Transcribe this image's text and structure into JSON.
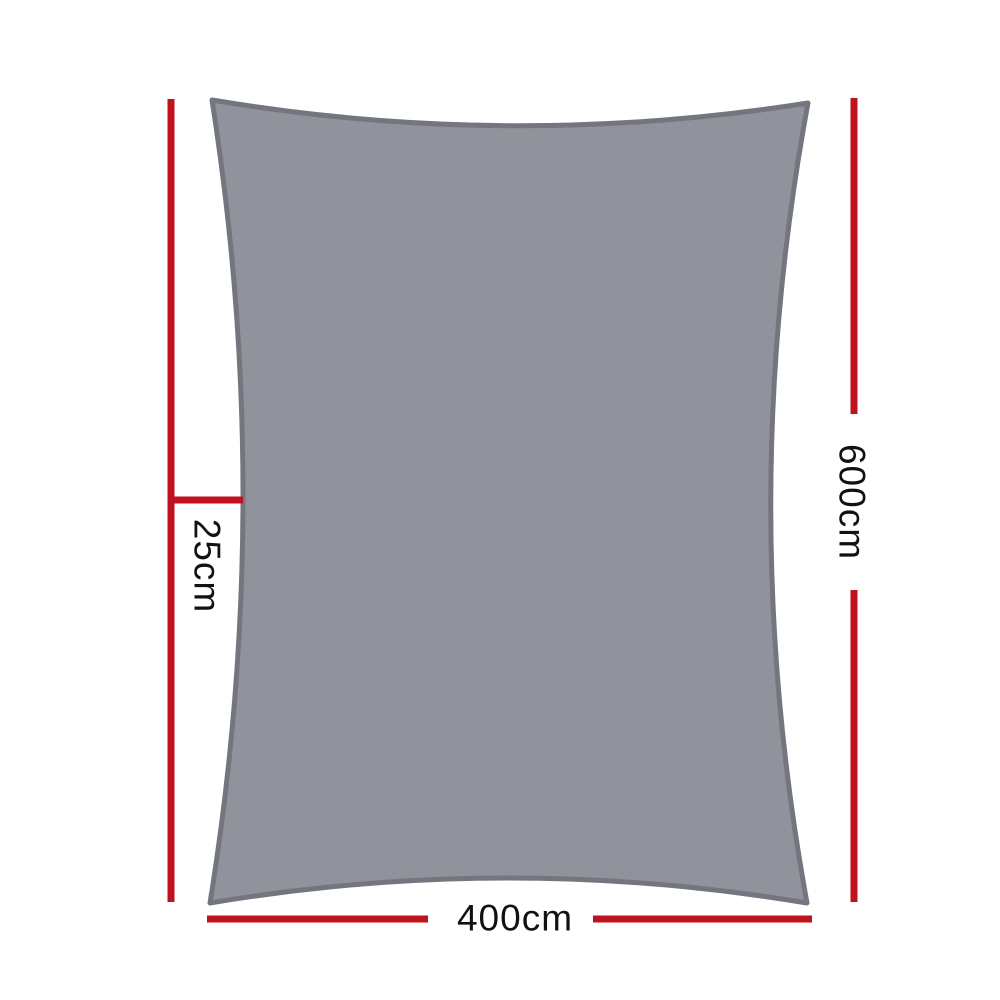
{
  "diagram": {
    "type": "product-dimension-diagram",
    "subject": "rectangle shade sail with concave edges",
    "labels": {
      "sag_depth": "25cm",
      "side_height": "600cm",
      "bottom_width": "400cm"
    },
    "dimensions_shown": [
      {
        "name": "sag-depth",
        "value_cm": 25,
        "orientation": "vertical-left-tick"
      },
      {
        "name": "height",
        "value_cm": 600,
        "orientation": "vertical-right"
      },
      {
        "name": "width",
        "value_cm": 400,
        "orientation": "horizontal-bottom"
      }
    ]
  },
  "colors": {
    "dimension_line": "#be121f",
    "sail_fill": "#90939b",
    "sail_border": "#74767f",
    "label_text": "#111111",
    "background": "#ffffff"
  }
}
